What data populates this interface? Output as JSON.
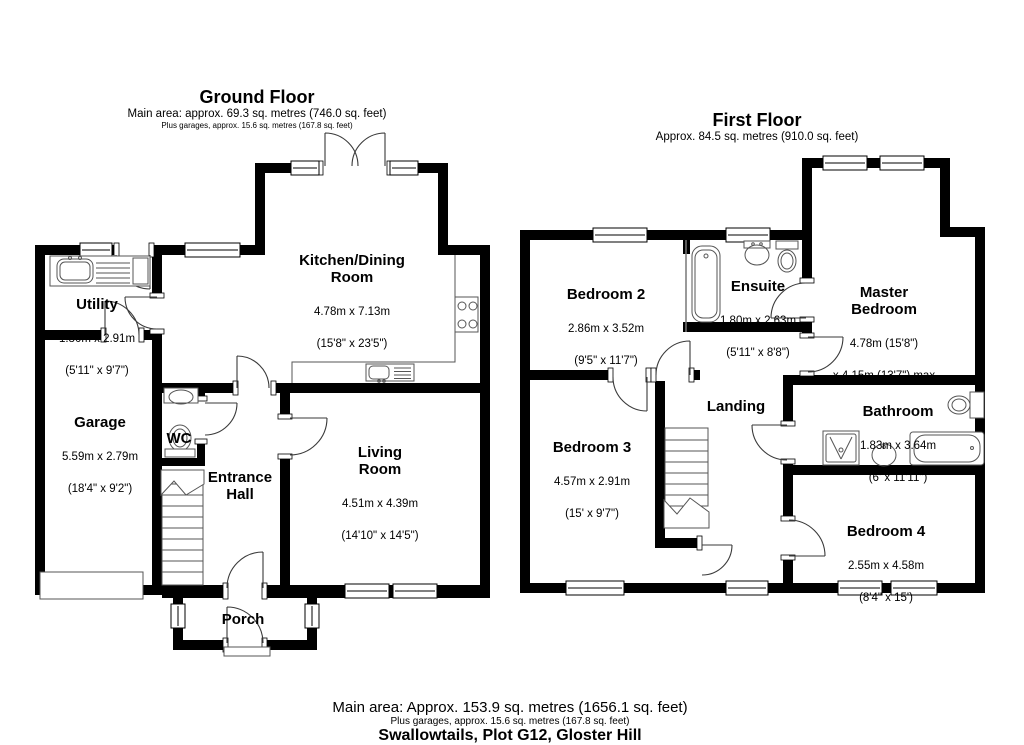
{
  "ground": {
    "title": "Ground Floor",
    "subtitle": "Main area: approx. 69.3 sq. metres (746.0 sq. feet)",
    "note": "Plus garages, approx. 15.6 sq. metres (167.8 sq. feet)",
    "rooms": {
      "kitchen": {
        "name": "Kitchen/Dining\nRoom",
        "metric": "4.78m x 7.13m",
        "imperial": "(15'8\" x 23'5\")"
      },
      "utility": {
        "name": "Utility",
        "metric": "1.80m x 2.91m",
        "imperial": "(5'11\" x 9'7\")"
      },
      "garage": {
        "name": "Garage",
        "metric": "5.59m x 2.79m",
        "imperial": "(18'4\" x 9'2\")"
      },
      "wc": {
        "name": "WC"
      },
      "hall": {
        "name": "Entrance\nHall"
      },
      "living": {
        "name": "Living\nRoom",
        "metric": "4.51m x 4.39m",
        "imperial": "(14'10\" x 14'5\")"
      },
      "porch": {
        "name": "Porch"
      }
    }
  },
  "first": {
    "title": "First Floor",
    "subtitle": "Approx. 84.5 sq. metres (910.0 sq. feet)",
    "rooms": {
      "bedroom2": {
        "name": "Bedroom 2",
        "metric": "2.86m x 3.52m",
        "imperial": "(9'5\" x 11'7\")"
      },
      "ensuite": {
        "name": "Ensuite",
        "metric": "1.80m x 2.63m",
        "imperial": "(5'11\" x 8'8\")"
      },
      "master": {
        "name": "Master\nBedroom",
        "metric": "4.78m (15'8\")",
        "imperial": "x 4.15m (13'7\") max"
      },
      "bedroom3": {
        "name": "Bedroom 3",
        "metric": "4.57m x 2.91m",
        "imperial": "(15' x 9'7\")"
      },
      "landing": {
        "name": "Landing"
      },
      "bathroom": {
        "name": "Bathroom",
        "metric": "1.83m x 3.64m",
        "imperial": "(6' x 11'11\")"
      },
      "bedroom4": {
        "name": "Bedroom 4",
        "metric": "2.55m x 4.58m",
        "imperial": "(8'4\" x 15')"
      }
    }
  },
  "footer": {
    "main": "Main area: Approx. 153.9 sq. metres (1656.1 sq. feet)",
    "note": "Plus garages, approx. 15.6 sq. metres (167.8 sq. feet)",
    "address": "Swallowtails, Plot G12, Gloster Hill"
  }
}
